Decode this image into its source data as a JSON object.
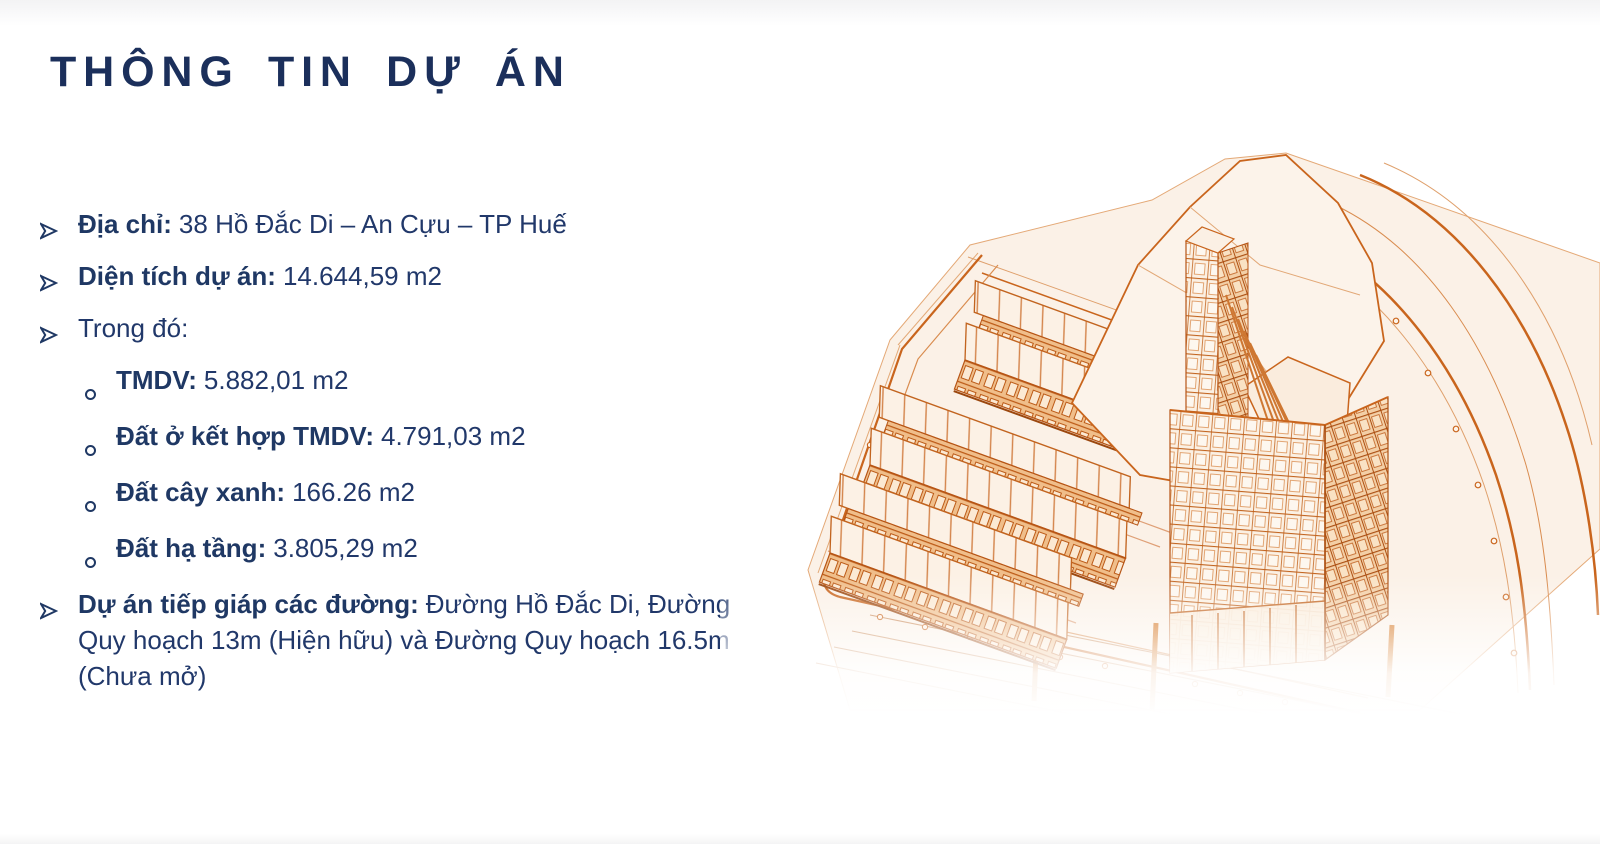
{
  "slide": {
    "title": "THÔNG TIN DỰ ÁN"
  },
  "info": {
    "items": [
      {
        "marker": "arrow",
        "label": "Địa chỉ:",
        "value": "38 Hồ Đắc Di – An Cựu – TP Huế"
      },
      {
        "marker": "arrow",
        "label": "Diện tích dự án:",
        "value": "14.644,59 m2"
      },
      {
        "marker": "arrow",
        "label": "",
        "value": "Trong đó:"
      },
      {
        "marker": "circle",
        "label": "TMDV:",
        "value": "5.882,01 m2"
      },
      {
        "marker": "circle",
        "label": "Đất ở kết hợp TMDV:",
        "value": "4.791,03 m2"
      },
      {
        "marker": "circle",
        "label": "Đất cây xanh:",
        "value": "166.26 m2"
      },
      {
        "marker": "circle",
        "label": "Đất hạ tầng:",
        "value": "3.805,29 m2"
      },
      {
        "marker": "arrow",
        "label": "Dự án tiếp giáp các đường:",
        "value": "Đường Hồ Đắc Di, Đường Quy hoạch 13m (Hiện hữu) và Đường Quy hoạch 16.5m (Chưa mở)"
      }
    ]
  },
  "illustration": {
    "name": "isometric-site-plan-line-drawing",
    "description": "Orange architectural line drawing: three rows of shophouses, a high-rise tower on podium, slender tower, surrounding roads with lane lines and street trees",
    "colors": {
      "line": "#C9651D",
      "line_dark": "#B65415",
      "fill_light": "#FBF1E7",
      "fill_facade": "#F2C391",
      "text_navy": "#1F3864",
      "title_navy": "#1B2F5B"
    }
  }
}
